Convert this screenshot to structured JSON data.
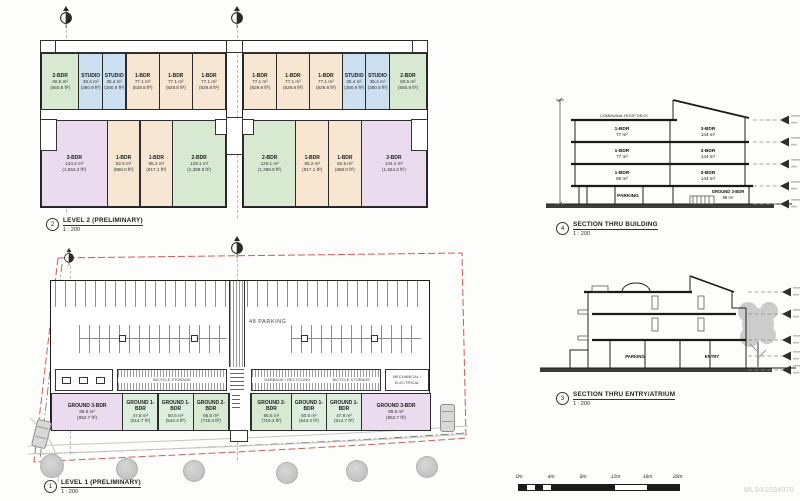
{
  "sheet": {
    "mls": "MLS®1034070"
  },
  "colors": {
    "green": "#d8e9d2",
    "blue": "#cce0f1",
    "tan": "#f7e6d1",
    "pink": "#eadbef",
    "mint": "#ddeede"
  },
  "labels": {
    "level2": {
      "num": "2",
      "title": "LEVEL 2 (PRELIMINARY)",
      "scale": "1 : 200"
    },
    "level1": {
      "num": "1",
      "title": "LEVEL 1 (PRELIMINARY)",
      "scale": "1 : 200"
    },
    "section_building": {
      "num": "4",
      "title": "SECTION THRU BUILDING",
      "scale": "1 : 200"
    },
    "section_entry": {
      "num": "3",
      "title": "SECTION THRU ENTRY/ATRIUM",
      "scale": "1 : 200"
    }
  },
  "level2": {
    "top_left": [
      {
        "type": "2-BDR",
        "m2": "60.5 m²",
        "ft": "(650.8 ft²)",
        "color": "green",
        "w": 34
      },
      {
        "type": "STUDIO",
        "m2": "35.4 m²",
        "ft": "(380.9 ft²)",
        "color": "blue",
        "w": 21
      },
      {
        "type": "STUDIO",
        "m2": "35.4 m²",
        "ft": "(380.9 ft²)",
        "color": "blue",
        "w": 21
      },
      {
        "type": "1-BDR",
        "m2": "77.1 m²",
        "ft": "(829.8 ft²)",
        "color": "tan",
        "w": 30
      },
      {
        "type": "1-BDR",
        "m2": "77.1 m²",
        "ft": "(829.8 ft²)",
        "color": "tan",
        "w": 30
      },
      {
        "type": "1-BDR",
        "m2": "77.1 m²",
        "ft": "(829.8 ft²)",
        "color": "tan",
        "w": 30
      }
    ],
    "top_right": [
      {
        "type": "1-BDR",
        "m2": "77.1 m²",
        "ft": "(829.8 ft²)",
        "color": "tan",
        "w": 30
      },
      {
        "type": "1-BDR",
        "m2": "77.1 m²",
        "ft": "(829.8 ft²)",
        "color": "tan",
        "w": 30
      },
      {
        "type": "1-BDR",
        "m2": "77.1 m²",
        "ft": "(829.8 ft²)",
        "color": "tan",
        "w": 30
      },
      {
        "type": "STUDIO",
        "m2": "35.4 m²",
        "ft": "(380.9 ft²)",
        "color": "blue",
        "w": 21
      },
      {
        "type": "STUDIO",
        "m2": "35.4 m²",
        "ft": "(380.9 ft²)",
        "color": "blue",
        "w": 21
      },
      {
        "type": "2-BDR",
        "m2": "60.5 m²",
        "ft": "(650.8 ft²)",
        "color": "green",
        "w": 34
      }
    ],
    "bottom_left": [
      {
        "type": "3-BDR",
        "m2": "144.4 m²",
        "ft": "(1,554.2 ft²)",
        "color": "pink",
        "w": 55
      },
      {
        "type": "1-BDR",
        "m2": "82.5 m²",
        "ft": "(888.0 ft²)",
        "color": "tan",
        "w": 27
      },
      {
        "type": "1-BDR",
        "m2": "85.2 m²",
        "ft": "(917.1 ft²)",
        "color": "tan",
        "w": 27
      },
      {
        "type": "2-BDR",
        "m2": "129.1 m²",
        "ft": "(1,389.8 ft²)",
        "color": "green",
        "w": 44
      }
    ],
    "bottom_right": [
      {
        "type": "2-BDR",
        "m2": "129.1 m²",
        "ft": "(1,389.8 ft²)",
        "color": "green",
        "w": 44
      },
      {
        "type": "1-BDR",
        "m2": "85.2 m²",
        "ft": "(917.1 ft²)",
        "color": "tan",
        "w": 27
      },
      {
        "type": "1-BDR",
        "m2": "82.5 m²",
        "ft": "(888.0 ft²)",
        "color": "tan",
        "w": 27
      },
      {
        "type": "3-BDR",
        "m2": "144.4 m²",
        "ft": "(1,554.2 ft²)",
        "color": "pink",
        "w": 55
      }
    ]
  },
  "level1": {
    "parking_label": "48 PARKING",
    "rooms": {
      "bike": "BICYCLE STORAGE",
      "garbage": "GARBAGE / RECYCLING",
      "mech1": "MECHANICAL /",
      "mech2": "ELECTRICAL"
    },
    "ground_left": [
      {
        "type": "GROUND 3-BDR",
        "m2": "88.5 m²",
        "ft": "(952.7 ft²)",
        "color": "pink",
        "w": 74
      },
      {
        "type": "GROUND 1-BDR",
        "m2": "47.8 m²",
        "ft": "(514.7 ft²)",
        "color": "mint",
        "w": 36
      },
      {
        "type": "GROUND 1-BDR",
        "m2": "50.5 m²",
        "ft": "(543.3 ft²)",
        "color": "mint",
        "w": 36
      },
      {
        "type": "GROUND 2-BDR",
        "m2": "66.5 m²",
        "ft": "(715.3 ft²)",
        "color": "green",
        "w": 36
      }
    ],
    "ground_right": [
      {
        "type": "GROUND 2-BDR",
        "m2": "66.5 m²",
        "ft": "(715.3 ft²)",
        "color": "green",
        "w": 40
      },
      {
        "type": "GROUND 1-BDR",
        "m2": "50.5 m²",
        "ft": "(543.3 ft²)",
        "color": "mint",
        "w": 35
      },
      {
        "type": "GROUND 1-BDR",
        "m2": "47.8 m²",
        "ft": "(514.7 ft²)",
        "color": "mint",
        "w": 35
      },
      {
        "type": "GROUND 3-BDR",
        "m2": "88.5 m²",
        "ft": "(952.7 ft²)",
        "color": "pink",
        "w": 70
      }
    ]
  },
  "section_building": {
    "roof_label": "COMMUNAL ROOF DECK",
    "rows": [
      {
        "lt": "1-BDR",
        "la": "77 m²",
        "rt": "3-BDR",
        "ra": "144 m²"
      },
      {
        "lt": "1-BDR",
        "la": "77 m²",
        "rt": "3-BDR",
        "ra": "144 m²"
      },
      {
        "lt": "1-BDR",
        "la": "85 m²",
        "rt": "3-BDR",
        "ra": "144 m²"
      }
    ],
    "parking": "PARKING",
    "ground_type": "GROUND 3-BDR",
    "ground_area": "88 m²"
  },
  "section_entry": {
    "parking": "PARKING",
    "entry": "ENTRY"
  },
  "scalebar": {
    "ticks": [
      "0m",
      "4m",
      "8m",
      "12m",
      "16m",
      "20m"
    ]
  }
}
